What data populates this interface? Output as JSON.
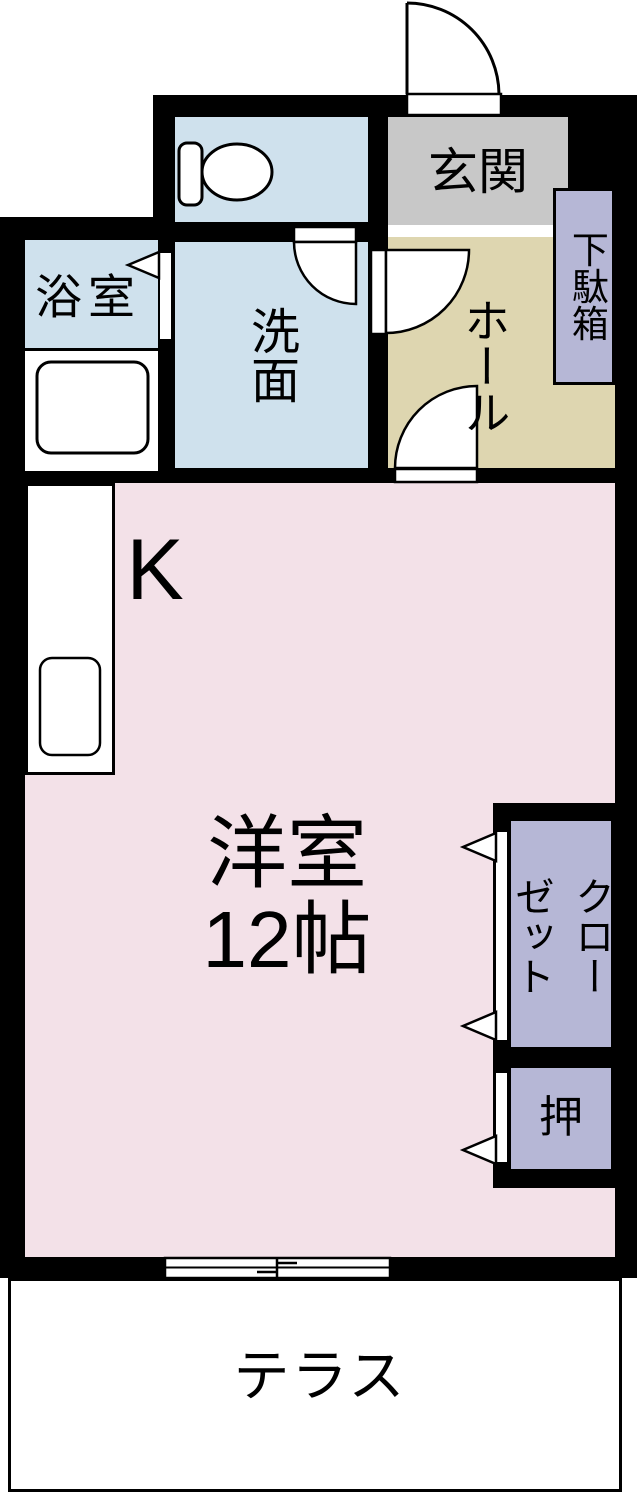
{
  "palette": {
    "wall": "#000000",
    "outline": "#000000",
    "background": "#ffffff",
    "water_blue": "#cfe1ed",
    "entrance_gray": "#c8c8c8",
    "hall_beige": "#ded6b0",
    "room_pink": "#f3e1e8",
    "closet_purple": "#b6b7d6",
    "terrace_white": "#ffffff"
  },
  "rooms": {
    "entrance": {
      "label": "玄関",
      "color": "#c8c8c8"
    },
    "shoe_cabinet": {
      "label": "下駄箱",
      "color": "#b6b7d6"
    },
    "hall": {
      "label": "ホール",
      "color": "#ded6b0"
    },
    "toilet": {
      "color": "#cfe1ed"
    },
    "washroom": {
      "label": "洗面",
      "color": "#cfe1ed"
    },
    "bathroom": {
      "label": "浴室",
      "color": "#cfe1ed"
    },
    "kitchen": {
      "label": "K",
      "color": "#f3e1e8"
    },
    "western_room": {
      "label_line1": "洋室",
      "label_line2": "12帖",
      "color": "#f3e1e8"
    },
    "closet": {
      "label_col1": "クロー",
      "label_col2": "ゼット",
      "color": "#b6b7d6"
    },
    "oshiire": {
      "label": "押",
      "color": "#b6b7d6"
    },
    "terrace": {
      "label": "テラス",
      "color": "#ffffff"
    }
  },
  "icons": {
    "entrance_door": "door-swing-icon",
    "interior_doors": "door-swing-icon",
    "bathroom_door": "folding-door-triangle-icon",
    "closet_doors": "sliding-door-triangle-icon",
    "toilet": "toilet-icon",
    "bathtub": "bathtub-icon",
    "kitchen_sink": "sink-icon",
    "window": "sliding-window-icon"
  }
}
